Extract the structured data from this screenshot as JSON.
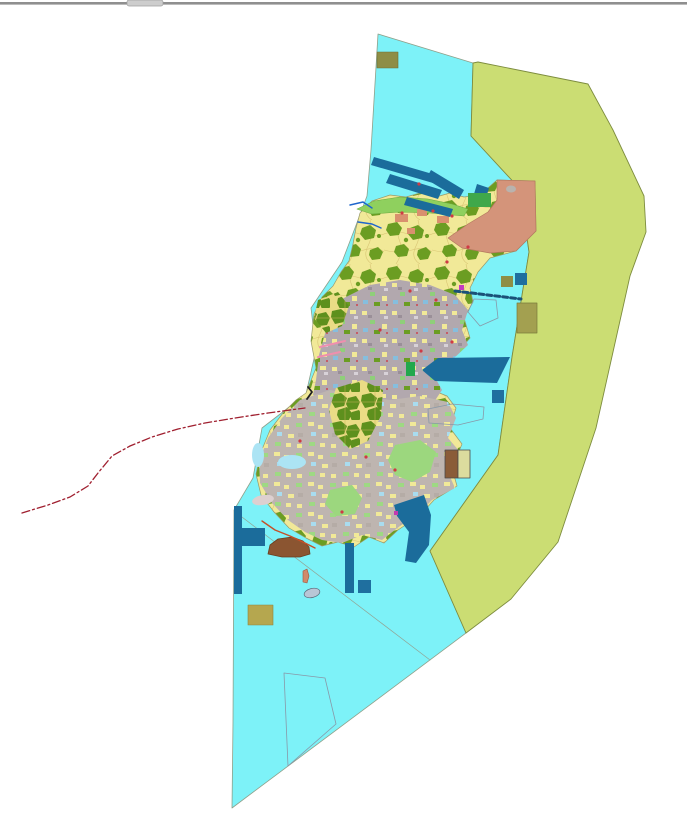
{
  "meta": {
    "view": "gis-landuse-map",
    "description": "Zoning / land-use map: cyan marine area, yellow-green eastern buffer zone, mosaic land-use island, red dash-dot boundary line"
  },
  "palette": {
    "sea": "#7DF2F8",
    "buffer_zone": "#CBDD73",
    "land_yellow": "#F1E998",
    "urban_gray": "#B2A8AE",
    "forest_olive": "#6B9D22",
    "structure_blue": "#1B6C9B",
    "salmon_zone": "#D4947A",
    "boundary_red": "#A02030",
    "window_edge": "#8F8F8F"
  },
  "map": {
    "width": 687,
    "height": 821,
    "background": "#ffffff",
    "features": [
      {
        "name": "window-top-edge",
        "type": "rect",
        "x": 0,
        "y": 2,
        "width": 687,
        "height": 2.6,
        "fill": "#8F8F8F",
        "interactable": false
      },
      {
        "name": "window-top-notch",
        "type": "rect",
        "x": 127,
        "y": 0,
        "width": 36,
        "height": 6,
        "rx": 2,
        "fill": "#CDCDCD",
        "stroke": "#9E9E9E",
        "sw": 0.7,
        "interactable": false
      },
      {
        "name": "sea-region",
        "type": "polygon",
        "points": "378,34 473,63 471,136 520,189 529,252 512,357 498,455 430,551 466,633 232,808 233,722 234,510 253,478 262,428 306,394 316,350 311,308 342,262 355,228 367,196 371,150",
        "fill": "#7DF2F8",
        "stroke": "#8FA08A",
        "sw": 0.8,
        "interactable": true
      },
      {
        "name": "buffer-zone-region",
        "type": "polygon",
        "points": "478,62 588,84 613,130 644,196 646,232 630,276 596,428 558,542 511,599 466,633 430,551 498,455 512,357 529,252 520,189 471,136 473,63",
        "fill": "#CBDD73",
        "stroke": "#7D8C3E",
        "sw": 0.9,
        "interactable": true
      },
      {
        "name": "sea-zone-divider-line",
        "type": "polyline",
        "points": "234,511 430,660",
        "fill": "none",
        "stroke": "#93A393",
        "sw": 0.7,
        "interactable": false
      },
      {
        "name": "island-landmass",
        "type": "polygon",
        "points": "360,213 372,201 390,195 406,197 420,193 436,197 450,193 464,197 480,195 497,180 535,181 536,231 516,251 490,258 478,272 470,288 473,302 464,318 470,338 456,354 424,368 416,380 432,390 447,396 456,408 450,428 462,444 452,468 457,486 434,500 423,512 410,522 398,530 384,543 369,537 354,547 338,542 322,546 306,538 289,528 274,512 261,495 256,474 261,452 270,430 283,413 296,400 306,393 316,368 311,341 314,314 322,297 333,286 341,272 349,261 353,244 356,228",
        "fill": "url(#patNorth)",
        "stroke": "#9A9A6A",
        "sw": 0.7,
        "interactable": true
      },
      {
        "name": "north-coast-green-strip",
        "type": "polygon",
        "points": "357,209 374,201 400,197 428,199 452,204 468,209 464,216 430,213 400,212 372,214",
        "fill": "#8FD05E",
        "stroke": "#6AA83E",
        "sw": 0.5,
        "interactable": false
      },
      {
        "name": "urban-mosaic-area",
        "type": "polygon",
        "points": "340,300 370,285 400,280 430,285 455,295 468,310 462,330 468,345 452,360 432,372 442,390 432,405 447,420 432,440 442,460 422,470 432,490 412,500 396,510 376,505 356,515 336,505 316,495 301,480 287,465 291,445 301,425 311,405 316,380 319,355 326,330 331,310",
        "fill": "url(#patUrban)",
        "interactable": false
      },
      {
        "name": "south-mosaic-area",
        "type": "polygon",
        "points": "300,400 330,390 360,396 390,400 420,396 448,402 456,418 448,438 460,452 448,472 455,488 432,500 418,514 400,526 382,540 362,535 342,543 322,540 305,532 288,520 272,503 260,483 259,462 268,438 282,418",
        "fill": "url(#patSouth)",
        "interactable": false
      },
      {
        "name": "forest-cluster-central",
        "type": "polygon",
        "points": "336,388 362,380 383,390 381,416 368,441 350,449 335,434 329,410",
        "fill": "url(#patOlive)",
        "interactable": false
      },
      {
        "name": "forest-cluster-west",
        "type": "polygon",
        "points": "318,300 338,292 349,306 342,326 326,333 314,318",
        "fill": "url(#patOlive)",
        "interactable": false
      },
      {
        "name": "meadow-patch-southeast",
        "type": "polygon",
        "points": "395,445 420,440 436,452 430,472 412,482 395,475 388,460",
        "fill": "#9CD77E",
        "interactable": false
      },
      {
        "name": "meadow-patch-south",
        "type": "polygon",
        "points": "330,490 352,485 362,498 355,514 336,516 325,504",
        "fill": "#9CD77E",
        "interactable": false
      },
      {
        "name": "lagoon-west",
        "type": "ellipse",
        "cx": 292,
        "cy": 462,
        "rx": 14,
        "ry": 7,
        "fill": "#ACE4F4",
        "interactable": false
      },
      {
        "name": "lagoon-far-west",
        "type": "ellipse",
        "cx": 258,
        "cy": 455,
        "rx": 6,
        "ry": 12,
        "fill": "#ACE4F4",
        "interactable": false
      },
      {
        "name": "salmon-zone-northeast",
        "type": "polygon",
        "points": "497,180 535,181 536,231 516,251 490,253 462,248 448,238 468,224 488,212 497,200",
        "fill": "#D4947A",
        "stroke": "#B4785E",
        "sw": 0.7,
        "interactable": false
      },
      {
        "name": "salmon-zone-inner-gray",
        "type": "ellipse",
        "cx": 511,
        "cy": 189,
        "rx": 5,
        "ry": 3.5,
        "fill": "#B9B3AE",
        "interactable": false
      },
      {
        "name": "village-patch-1",
        "type": "rect",
        "x": 395,
        "y": 214,
        "width": 13,
        "height": 8,
        "fill": "#D9906E",
        "interactable": false
      },
      {
        "name": "village-patch-2",
        "type": "rect",
        "x": 417,
        "y": 209,
        "width": 10,
        "height": 7,
        "fill": "#D9906E",
        "interactable": false
      },
      {
        "name": "village-patch-3",
        "type": "rect",
        "x": 437,
        "y": 216,
        "width": 12,
        "height": 7,
        "fill": "#D9906E",
        "interactable": false
      },
      {
        "name": "village-patch-4",
        "type": "rect",
        "x": 407,
        "y": 228,
        "width": 8,
        "height": 6,
        "fill": "#D9906E",
        "interactable": false
      },
      {
        "name": "breakwater-bar-1",
        "type": "polygon",
        "points": "374,157 436,175 433,183 371,165",
        "fill": "#1B6C9B",
        "interactable": false
      },
      {
        "name": "breakwater-bar-2",
        "type": "polygon",
        "points": "390,174 442,190 438,199 386,183",
        "fill": "#1B6C9B",
        "interactable": false
      },
      {
        "name": "breakwater-bar-3",
        "type": "polygon",
        "points": "431,170 464,190 459,199 426,179",
        "fill": "#1B6C9B",
        "interactable": false
      },
      {
        "name": "breakwater-bar-4",
        "type": "polygon",
        "points": "407,197 453,209 450,217 404,205",
        "fill": "#1B6C9B",
        "interactable": false
      },
      {
        "name": "pier-block-northeast",
        "type": "polygon",
        "points": "477,184 489,188 486,198 474,194",
        "fill": "#1B6C9B",
        "interactable": false
      },
      {
        "name": "green-facility-square",
        "type": "rect",
        "x": 468,
        "y": 193,
        "width": 23,
        "height": 14,
        "fill": "#3FA84A",
        "interactable": false
      },
      {
        "name": "jetty-dashed-line",
        "type": "polyline",
        "points": "455,291 521,299",
        "fill": "none",
        "stroke": "#1A5178",
        "sw": 3,
        "dash": "5,3",
        "interactable": false
      },
      {
        "name": "khaki-square-east",
        "type": "rect",
        "x": 501,
        "y": 276,
        "width": 12,
        "height": 11,
        "fill": "#8E8E46",
        "interactable": false
      },
      {
        "name": "blue-square-east",
        "type": "rect",
        "x": 515,
        "y": 273,
        "width": 12,
        "height": 12,
        "fill": "#1F6F9F",
        "interactable": false
      },
      {
        "name": "khaki-rect-buffer-edge",
        "type": "rect",
        "x": 517,
        "y": 303,
        "width": 20,
        "height": 30,
        "fill": "#A3A050",
        "stroke": "#7A7A3A",
        "sw": 0.7,
        "interactable": false
      },
      {
        "name": "khaki-rect-north",
        "type": "rect",
        "x": 377,
        "y": 52,
        "width": 21,
        "height": 16,
        "fill": "#8E8E46",
        "stroke": "#6F6F35",
        "sw": 0.6,
        "interactable": false
      },
      {
        "name": "port-anchorage-polygon",
        "type": "polygon",
        "points": "422,370 438,358 510,357 497,383 435,381",
        "fill": "#1B6C9B",
        "interactable": false
      },
      {
        "name": "port-small-square",
        "type": "rect",
        "x": 492,
        "y": 390,
        "width": 12,
        "height": 13,
        "fill": "#1F6F9F",
        "interactable": false
      },
      {
        "name": "green-strip-harbourside",
        "type": "rect",
        "x": 406,
        "y": 362,
        "width": 9,
        "height": 14,
        "fill": "#22A84C",
        "interactable": false
      },
      {
        "name": "harbour-band-southeast",
        "type": "polygon",
        "points": "394,505 424,495 431,515 429,545 416,563 405,561 409,532 397,516",
        "fill": "#1B6C9B",
        "interactable": false
      },
      {
        "name": "pier-structure-vertical-west",
        "type": "rect",
        "x": 234,
        "y": 506,
        "width": 8,
        "height": 88,
        "fill": "#1B6C9B",
        "interactable": false
      },
      {
        "name": "pier-structure-arm-west",
        "type": "rect",
        "x": 242,
        "y": 528,
        "width": 23,
        "height": 18,
        "fill": "#1B6C9B",
        "interactable": false
      },
      {
        "name": "pier-bar-south",
        "type": "rect",
        "x": 345,
        "y": 543,
        "width": 9,
        "height": 50,
        "fill": "#1B6C9B",
        "interactable": false
      },
      {
        "name": "pier-square-south",
        "type": "rect",
        "x": 358,
        "y": 580,
        "width": 13,
        "height": 13,
        "fill": "#1F6F9F",
        "interactable": false
      },
      {
        "name": "facility-split-rect-brown",
        "type": "rect",
        "x": 445,
        "y": 450,
        "width": 13,
        "height": 28,
        "fill": "#8A5C38",
        "stroke": "#4A4A4A",
        "sw": 0.8,
        "interactable": false
      },
      {
        "name": "facility-split-rect-beige",
        "type": "rect",
        "x": 458,
        "y": 450,
        "width": 12,
        "height": 28,
        "fill": "#DCDC9E",
        "stroke": "#4A4A4A",
        "sw": 0.8,
        "interactable": false
      },
      {
        "name": "khaki-rect-southwest",
        "type": "rect",
        "x": 248,
        "y": 605,
        "width": 25,
        "height": 20,
        "fill": "#B5A74F",
        "stroke": "#8E8440",
        "sw": 0.6,
        "interactable": false
      },
      {
        "name": "zone-outline-east",
        "type": "polygon",
        "points": "474,299 496,300 498,318 480,326 468,312",
        "fill": "none",
        "stroke": "#8898A8",
        "sw": 0.8,
        "interactable": false
      },
      {
        "name": "zone-outline-hexagon",
        "type": "polygon",
        "points": "428,409 452,404 484,407 483,419 458,425 429,423",
        "fill": "none",
        "stroke": "#8898A8",
        "sw": 0.8,
        "interactable": false
      },
      {
        "name": "zone-outline-trapezoid-south",
        "type": "polygon",
        "points": "284,673 325,678 336,724 288,766",
        "fill": "none",
        "stroke": "#8898A8",
        "sw": 0.8,
        "interactable": false
      },
      {
        "name": "brown-islet-south",
        "type": "polygon",
        "points": "268,554 270,545 278,539 292,537 303,541 309,547 310,554 300,557 282,557",
        "fill": "#8B5531",
        "stroke": "#6A3F20",
        "sw": 0.8,
        "interactable": false
      },
      {
        "name": "coast-erosion-line",
        "type": "polyline",
        "points": "262,521 275,530 290,536 305,543 315,548",
        "fill": "none",
        "stroke": "#C55028",
        "sw": 1.4,
        "interactable": false
      },
      {
        "name": "islet-salmon",
        "type": "polygon",
        "points": "303,571 307,569 309,576 307,583 303,582",
        "fill": "#D08A6A",
        "stroke": "#A05540",
        "sw": 0.6,
        "interactable": false
      },
      {
        "name": "islet-gray",
        "type": "ellipse",
        "cx": 312,
        "cy": 593,
        "rx": 8,
        "ry": 4.5,
        "fill": "#B9C6D6",
        "stroke": "#5A6A7A",
        "sw": 0.7,
        "transform": "rotate(-14 312 593)",
        "interactable": false
      },
      {
        "name": "mudflat-blob-west",
        "type": "ellipse",
        "cx": 263,
        "cy": 500,
        "rx": 11,
        "ry": 5,
        "fill": "#DDD0D0",
        "transform": "rotate(-10 263 500)",
        "interactable": false
      },
      {
        "name": "pink-road-1",
        "type": "polyline",
        "points": "320,347 345,341",
        "fill": "none",
        "stroke": "#EF8FAE",
        "sw": 2,
        "interactable": false
      },
      {
        "name": "pink-road-2",
        "type": "polyline",
        "points": "318,357 340,352",
        "fill": "none",
        "stroke": "#EF8FAE",
        "sw": 2,
        "interactable": false
      },
      {
        "name": "stream-line-1",
        "type": "polyline",
        "points": "350,205 363,202 372,208",
        "fill": "none",
        "stroke": "#1F66CC",
        "sw": 1.5,
        "interactable": false
      },
      {
        "name": "stream-line-2",
        "type": "polyline",
        "points": "358,222 372,224 381,228",
        "fill": "none",
        "stroke": "#1F66CC",
        "sw": 1.5,
        "interactable": false
      },
      {
        "name": "administrative-boundary-line",
        "type": "polyline",
        "points": "22,513 48,505 70,497 88,486 98,473 112,456 130,446 152,437 178,429 205,423 235,418 268,413 305,408",
        "fill": "none",
        "stroke": "#A02030",
        "sw": 1.3,
        "dash": "8 3 2 3",
        "interactable": false
      },
      {
        "name": "boundary-end-tick",
        "type": "polyline",
        "points": "307,399 312,392 308,387",
        "fill": "none",
        "stroke": "#202020",
        "sw": 1.8,
        "interactable": false
      },
      {
        "name": "magenta-marker-east",
        "type": "rect",
        "x": 459,
        "y": 285,
        "width": 5,
        "height": 5,
        "fill": "#C23AC2",
        "interactable": false
      },
      {
        "name": "magenta-marker-south",
        "type": "rect",
        "x": 394,
        "y": 511,
        "width": 4,
        "height": 4,
        "fill": "#C23AB0",
        "interactable": false
      },
      {
        "name": "settlement-red-dots",
        "type": "dots",
        "r": 1.6,
        "fill": "#CF3A44",
        "points": [
          [
            402,
            213
          ],
          [
            433,
            211
          ],
          [
            452,
            216
          ],
          [
            468,
            247
          ],
          [
            447,
            262
          ],
          [
            410,
            291
          ],
          [
            452,
            342
          ],
          [
            421,
            351
          ],
          [
            395,
            470
          ],
          [
            342,
            512
          ],
          [
            300,
            441
          ],
          [
            366,
            457
          ],
          [
            419,
            184
          ],
          [
            436,
            300
          ],
          [
            380,
            330
          ]
        ],
        "interactable": false
      }
    ]
  }
}
